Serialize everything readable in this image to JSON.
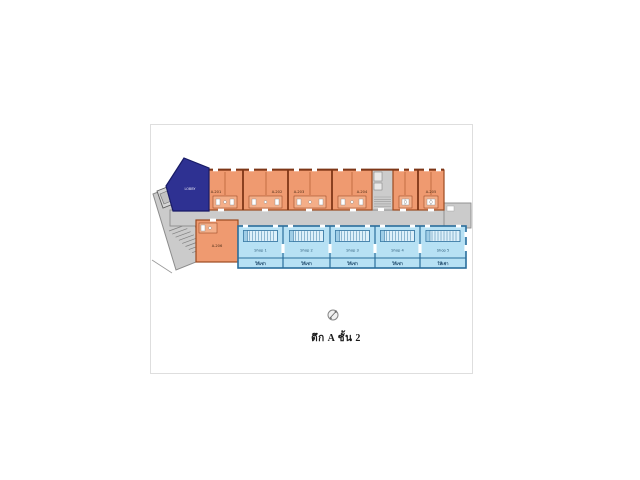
{
  "plan": {
    "caption": "ตึก A ชั้น 2",
    "navy_unit_label": "LOBBY",
    "rooms": [
      {
        "label": "A-201"
      },
      {
        "label": "A-202"
      },
      {
        "label": "A-203"
      },
      {
        "label": "A-204"
      },
      {
        "label": "A-205"
      },
      {
        "label": "A-206"
      }
    ],
    "shops": [
      {
        "label": "Shop 1",
        "sublabel": "ให้เช่า"
      },
      {
        "label": "Shop 2",
        "sublabel": "ให้เช่า"
      },
      {
        "label": "Shop 3",
        "sublabel": "ให้เช่า"
      },
      {
        "label": "Shop 4",
        "sublabel": "ให้เช่า"
      },
      {
        "label": "Shop 5",
        "sublabel": "ให้เช่า"
      }
    ],
    "icons": {
      "compass": "compass-north-icon"
    },
    "colors": {
      "room_fill": "#EF9A70",
      "room_bath_fill": "#F4AE88",
      "room_wall": "#8E3D1B",
      "room_partition": "#B15C30",
      "shop_fill": "#B7E1F4",
      "shop_stair_fill": "#DDF0FA",
      "shop_wall": "#2A6E9C",
      "corridor_fill": "#CBCBCB",
      "corridor_stroke": "#8C8C8C",
      "navy_fill": "#2E3192",
      "navy_stroke": "#181B66"
    }
  }
}
